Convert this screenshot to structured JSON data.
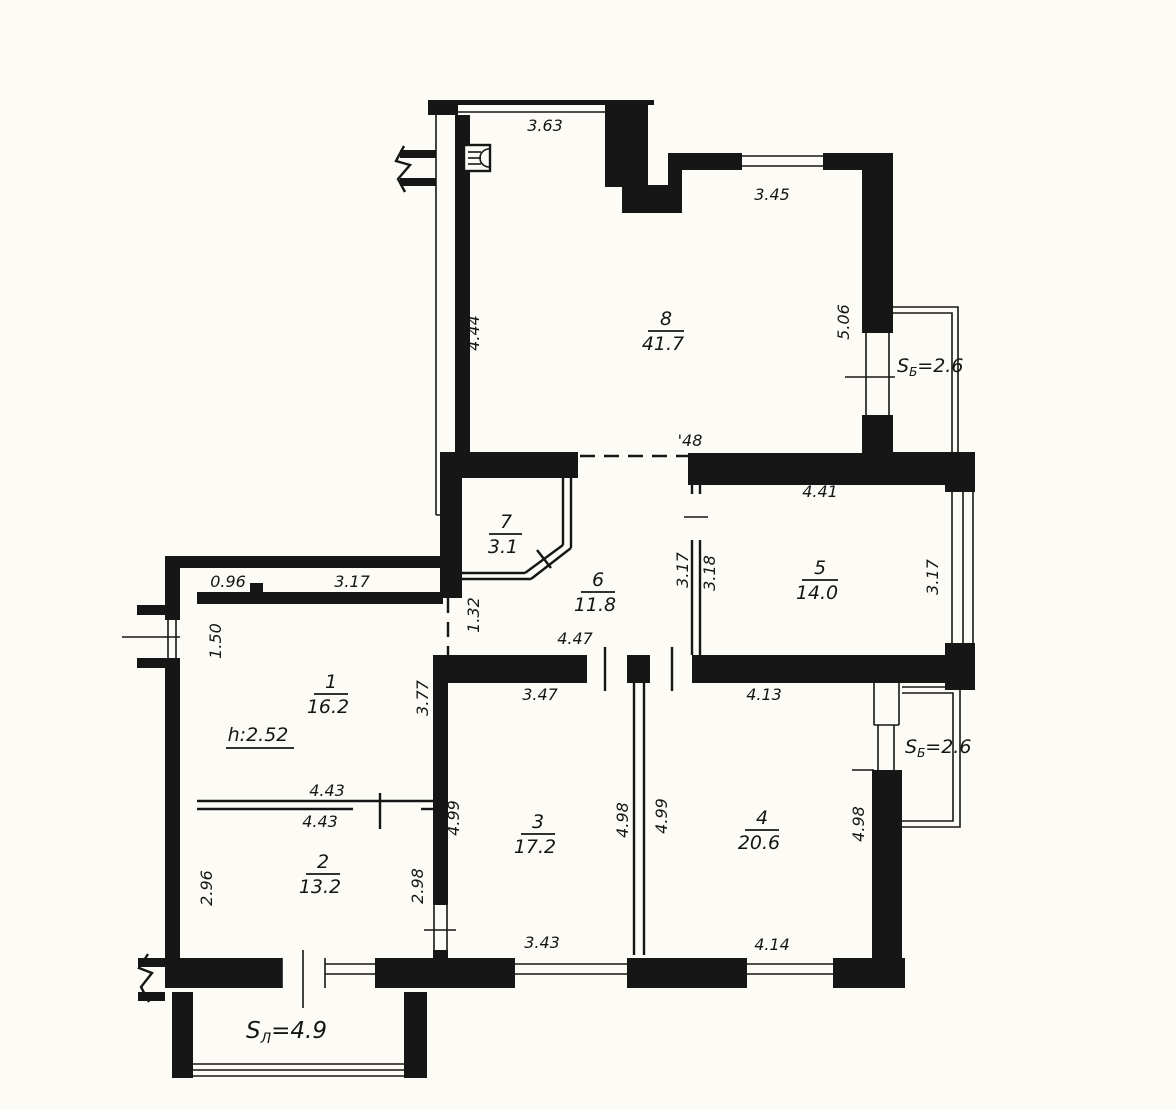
{
  "drawing": {
    "type": "apartment-floor-plan",
    "colors": {
      "ink": "#161616",
      "paper": "#fcfbf6"
    },
    "rooms": {
      "r1": {
        "number": "1",
        "area": "16.2"
      },
      "r2": {
        "number": "2",
        "area": "13.2"
      },
      "r3": {
        "number": "3",
        "area": "17.2"
      },
      "r4": {
        "number": "4",
        "area": "20.6"
      },
      "r5": {
        "number": "5",
        "area": "14.0"
      },
      "r6": {
        "number": "6",
        "area": "11.8"
      },
      "r7": {
        "number": "7",
        "area": "3.1"
      },
      "r8": {
        "number": "8",
        "area": "41.7"
      }
    },
    "height_note": "h:2.52",
    "balconies": {
      "top_right": {
        "s": "S",
        "sub": "Б",
        "eq": "=2.6"
      },
      "right": {
        "s": "S",
        "sub": "Б",
        "eq": "=2.6"
      },
      "bottom": {
        "s": "S",
        "sub": "Л",
        "eq": "=4.9"
      }
    },
    "dims": {
      "d363": "3.63",
      "d138": "1.38",
      "d345": "3.45",
      "d506": "5.06",
      "d444": "4.44",
      "d148": "'48",
      "d441": "4.41",
      "d317_hall": "3.17",
      "d318": "3.18",
      "d317_r5": "3.17",
      "d096": "0.96",
      "d317_r1": "3.17",
      "d150": "1.50",
      "d132": "1.32",
      "d447": "4.47",
      "d377": "3.77",
      "d347": "3.47",
      "d413": "4.13",
      "d443_top": "4.43",
      "d443_bot": "4.43",
      "d296": "2.96",
      "d298": "2.98",
      "d499_r3": "4.99",
      "d498_part": "4.98",
      "d499_part": "4.99",
      "d498_r4": "4.98",
      "d343": "3.43",
      "d414": "4.14"
    },
    "icons": {
      "appliance": "stove-icon"
    }
  }
}
